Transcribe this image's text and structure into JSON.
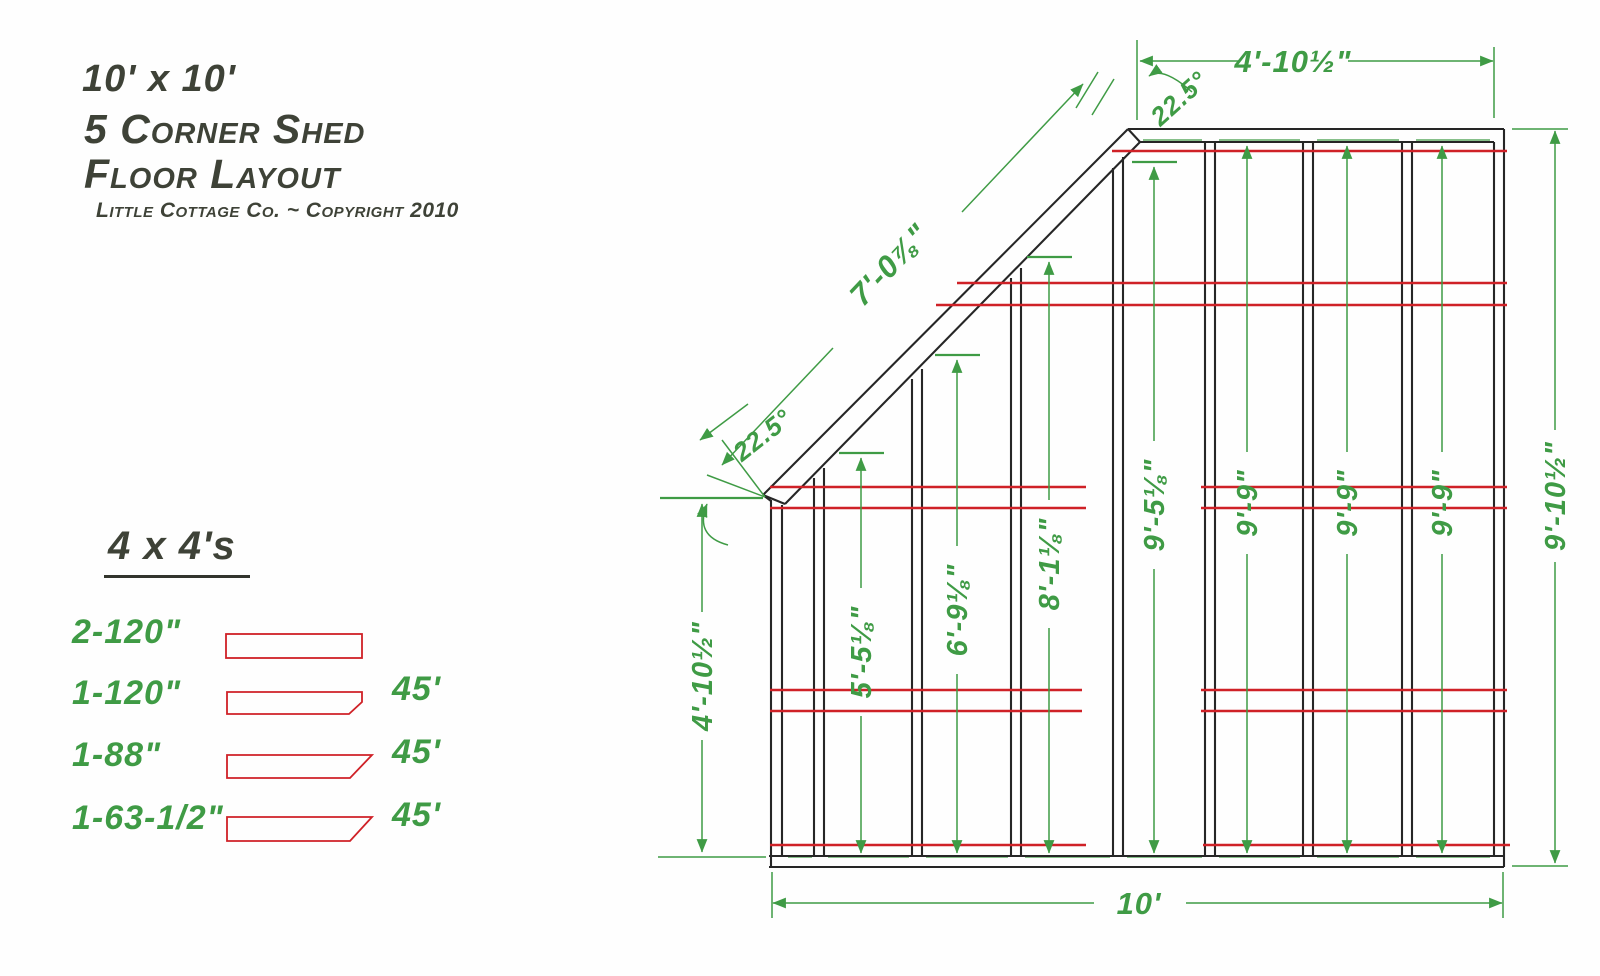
{
  "title": {
    "size_line": "10' x 10'",
    "name_line": "5 Corner Shed",
    "type_line": "Floor Layout",
    "subtitle": "Little Cottage Co. ~ Copyright 2010"
  },
  "legend": {
    "heading": "4 x 4's",
    "items": [
      {
        "qty_label": "2-120\"",
        "angle_note": ""
      },
      {
        "qty_label": "1-120\"",
        "angle_note": "45'"
      },
      {
        "qty_label": "1-88\"",
        "angle_note": "45'"
      },
      {
        "qty_label": "1-63-1/2\"",
        "angle_note": "45'"
      }
    ]
  },
  "dims": {
    "top_width": "4'-10½\"",
    "top_angle": "22.5°",
    "diagonal_length": "7'-0⅞\"",
    "left_angle": "22.5°",
    "left_height": "4'-10½\"",
    "right_height": "9'-10½\"",
    "bottom_width": "10'",
    "joist_lengths": [
      "5'-5⅛\"",
      "6'-9⅛\"",
      "8'-1⅛\"",
      "9'-5⅛\"",
      "9'-9\"",
      "9'-9\"",
      "9'-9\""
    ]
  },
  "colors": {
    "dimension_green": "#3f9b45",
    "runner_red": "#cf2127",
    "frame_black": "#262626",
    "lettering_gray": "#3e4237"
  }
}
